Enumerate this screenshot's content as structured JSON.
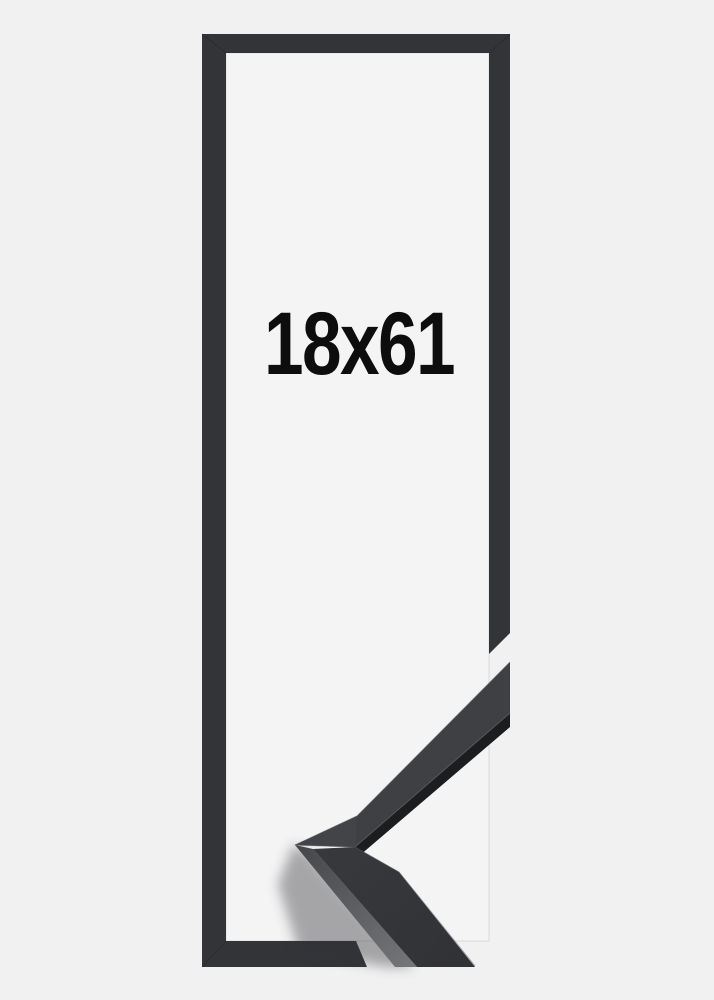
{
  "product_image": {
    "size_label": "18x61"
  },
  "colors": {
    "background": "#f1f1f2",
    "frame_opening": "#f4f4f5",
    "frame_flat": "#333438",
    "moulding_face_upper": "#3f4043",
    "moulding_face_lower": "#343539",
    "moulding_mitre_face": "#434447",
    "moulding_edge_dark": "#1c1d1f",
    "moulding_side_highlight": "#747578",
    "label_text": "#0d0d0e"
  }
}
